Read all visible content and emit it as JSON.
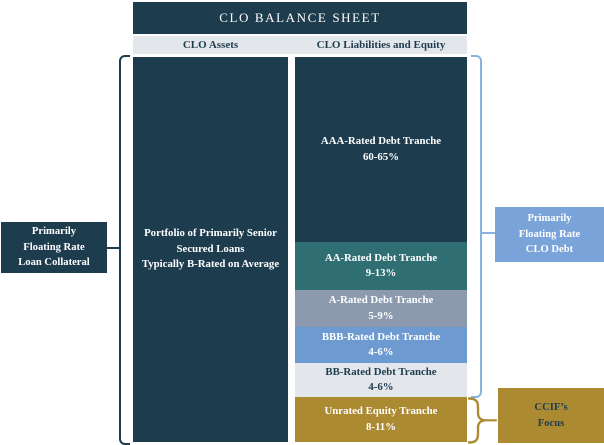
{
  "title": "CLO BALANCE SHEET",
  "assets": {
    "header": "CLO Assets",
    "body": [
      "Portfolio of Primarily Senior",
      "Secured Loans",
      "Typically B-Rated on Average"
    ]
  },
  "liabilities": {
    "header": "CLO Liabilities and Equity",
    "tranches": [
      {
        "label": "AAA-Rated Debt Tranche",
        "pct": "60-65%",
        "bg": "#1d3c4e",
        "fg": "#ffffff",
        "h": 185
      },
      {
        "label": "AA-Rated Debt Tranche",
        "pct": "9-13%",
        "bg": "#2f6e73",
        "fg": "#ffffff",
        "h": 48
      },
      {
        "label": "A-Rated Debt Tranche",
        "pct": "5-9%",
        "bg": "#8c9ab0",
        "fg": "#ffffff",
        "h": 37
      },
      {
        "label": "BBB-Rated Debt Tranche",
        "pct": "4-6%",
        "bg": "#6e9ad2",
        "fg": "#ffffff",
        "h": 36
      },
      {
        "label": "BB-Rated Debt Tranche",
        "pct": "4-6%",
        "bg": "#e3e6eb",
        "fg": "#1d3c4e",
        "h": 34
      },
      {
        "label": "Unrated Equity Tranche",
        "pct": "8-11%",
        "bg": "#ab8a31",
        "fg": "#ffffff",
        "h": 45
      }
    ]
  },
  "callouts": {
    "loan_collateral": {
      "lines": [
        "Primarily",
        "Floating Rate",
        "Loan Collateral"
      ],
      "bg": "#1d3c4e",
      "fg": "#ffffff"
    },
    "clo_debt": {
      "lines": [
        "Primarily",
        "Floating Rate",
        "CLO Debt"
      ],
      "bg": "#7aa3d9",
      "fg": "#ffffff"
    },
    "ccif_focus": {
      "lines": [
        "CCIF’s",
        "Focus"
      ],
      "bg": "#ab8a31",
      "fg": "#1d3c4e"
    }
  },
  "colors": {
    "navy": "#1d3c4e",
    "header_bar": "#e3e6eb",
    "left_bracket": "#1d3c4e",
    "right_bracket": "#8ab1e0",
    "equity_brace": "#ab8a31"
  }
}
